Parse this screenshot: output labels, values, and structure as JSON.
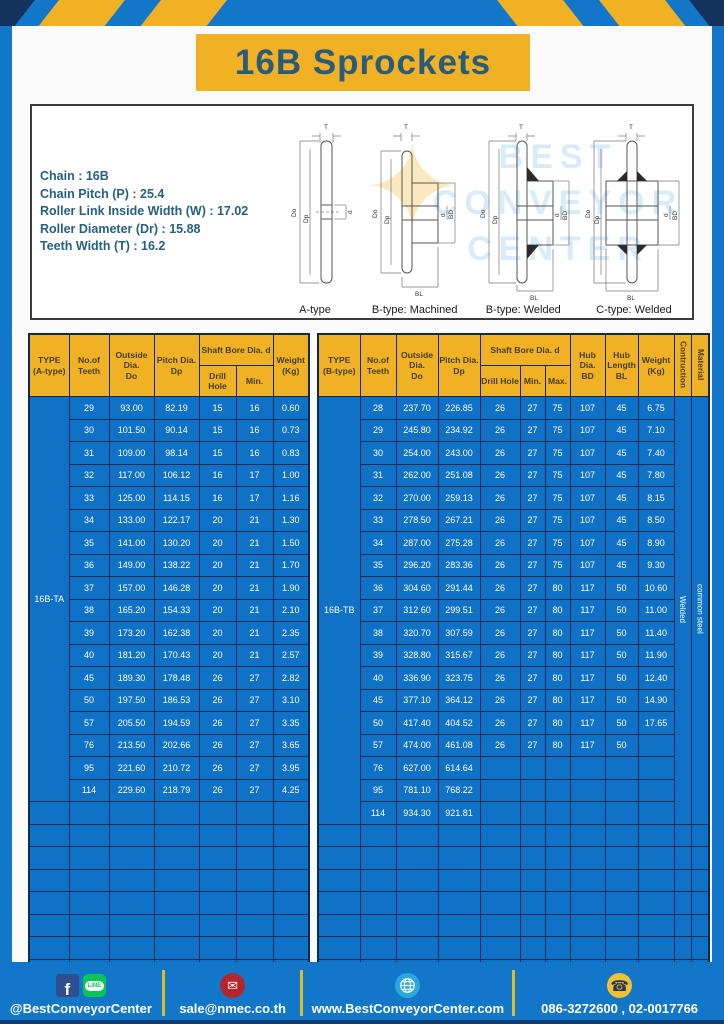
{
  "page_title": "16B Sprockets",
  "specs": {
    "lines": [
      "Chain : 16B",
      "Chain Pitch (P) : 25.4",
      "Roller Link Inside Width (W) : 17.02",
      "Roller Diameter (Dr) : 15.88",
      "Teeth Width (T) : 16.2"
    ]
  },
  "diagrams": {
    "labels": [
      "A-type",
      "B-type: Machined",
      "B-type: Welded",
      "C-type: Welded"
    ],
    "dims": {
      "T": "T",
      "Do": "Do",
      "Dp": "Dp",
      "d": "d",
      "BD": "BD",
      "BL": "BL"
    }
  },
  "watermark": {
    "star": "✦",
    "lines": "BEST\nCONVEYOR\nCENTER"
  },
  "table_a": {
    "header": {
      "type": "TYPE\n(A-type)",
      "teeth": "No.of\nTeeth",
      "outside": "Outside\nDia.\nDo",
      "pitch": "Pitch Dia.\nDp",
      "shaft_bore": "Shaft Bore Dia. d",
      "drill": "Drill Hole",
      "min": "Min.",
      "weight": "Weight\n(Kg)"
    },
    "type_label": "16B-TA",
    "rows": [
      [
        "29",
        "93.00",
        "82.19",
        "15",
        "16",
        "0.60"
      ],
      [
        "30",
        "101.50",
        "90.14",
        "15",
        "16",
        "0.73"
      ],
      [
        "31",
        "109.00",
        "98.14",
        "15",
        "16",
        "0.83"
      ],
      [
        "32",
        "117.00",
        "106.12",
        "16",
        "17",
        "1.00"
      ],
      [
        "33",
        "125.00",
        "114.15",
        "16",
        "17",
        "1.16"
      ],
      [
        "34",
        "133.00",
        "122.17",
        "20",
        "21",
        "1.30"
      ],
      [
        "35",
        "141.00",
        "130.20",
        "20",
        "21",
        "1.50"
      ],
      [
        "36",
        "149.00",
        "138.22",
        "20",
        "21",
        "1.70"
      ],
      [
        "37",
        "157.00",
        "146.28",
        "20",
        "21",
        "1.90"
      ],
      [
        "38",
        "165.20",
        "154.33",
        "20",
        "21",
        "2.10"
      ],
      [
        "39",
        "173.20",
        "162.38",
        "20",
        "21",
        "2.35"
      ],
      [
        "40",
        "181.20",
        "170.43",
        "20",
        "21",
        "2.57"
      ],
      [
        "45",
        "189.30",
        "178.48",
        "26",
        "27",
        "2.82"
      ],
      [
        "50",
        "197.50",
        "186.53",
        "26",
        "27",
        "3.10"
      ],
      [
        "57",
        "205.50",
        "194.59",
        "26",
        "27",
        "3.35"
      ],
      [
        "76",
        "213.50",
        "202.66",
        "26",
        "27",
        "3.65"
      ],
      [
        "95",
        "221.60",
        "210.72",
        "26",
        "27",
        "3.95"
      ],
      [
        "114",
        "229.60",
        "218.79",
        "26",
        "27",
        "4.25"
      ]
    ],
    "empty_rows": 8,
    "total_cols": 7
  },
  "table_b": {
    "header": {
      "type": "TYPE\n(B-type)",
      "teeth": "No.of\nTeeth",
      "outside": "Outside\nDia.\nDo",
      "pitch": "Pitch Dia.\nDp",
      "shaft_bore": "Shaft Bore Dia. d",
      "drill": "Drill Hole",
      "min": "Min.",
      "max": "Max.",
      "hub_dia": "Hub Dia.\nBD",
      "hub_len": "Hub\nLength\nBL",
      "weight": "Weight\n(Kg)",
      "construction": "Contruction",
      "material": "Material"
    },
    "type_label": "16B-TB",
    "construction_value": "Welded",
    "material_value": "common steel",
    "rows": [
      [
        "28",
        "237.70",
        "226.85",
        "26",
        "27",
        "75",
        "107",
        "45",
        "6.75"
      ],
      [
        "29",
        "245.80",
        "234.92",
        "26",
        "27",
        "75",
        "107",
        "45",
        "7.10"
      ],
      [
        "30",
        "254.00",
        "243.00",
        "26",
        "27",
        "75",
        "107",
        "45",
        "7.40"
      ],
      [
        "31",
        "262.00",
        "251.08",
        "26",
        "27",
        "75",
        "107",
        "45",
        "7.80"
      ],
      [
        "32",
        "270.00",
        "259.13",
        "26",
        "27",
        "75",
        "107",
        "45",
        "8.15"
      ],
      [
        "33",
        "278.50",
        "267.21",
        "26",
        "27",
        "75",
        "107",
        "45",
        "8.50"
      ],
      [
        "34",
        "287.00",
        "275.28",
        "26",
        "27",
        "75",
        "107",
        "45",
        "8.90"
      ],
      [
        "35",
        "296.20",
        "283.36",
        "26",
        "27",
        "75",
        "107",
        "45",
        "9.30"
      ],
      [
        "36",
        "304.60",
        "291.44",
        "26",
        "27",
        "80",
        "117",
        "50",
        "10.60"
      ],
      [
        "37",
        "312.60",
        "299.51",
        "26",
        "27",
        "80",
        "117",
        "50",
        "11.00"
      ],
      [
        "38",
        "320.70",
        "307.59",
        "26",
        "27",
        "80",
        "117",
        "50",
        "11.40"
      ],
      [
        "39",
        "328.80",
        "315.67",
        "26",
        "27",
        "80",
        "117",
        "50",
        "11.90"
      ],
      [
        "40",
        "336.90",
        "323.75",
        "26",
        "27",
        "80",
        "117",
        "50",
        "12.40"
      ],
      [
        "45",
        "377.10",
        "364.12",
        "26",
        "27",
        "80",
        "117",
        "50",
        "14.90"
      ],
      [
        "50",
        "417.40",
        "404.52",
        "26",
        "27",
        "80",
        "117",
        "50",
        "17.65"
      ],
      [
        "57",
        "474.00",
        "461.08",
        "26",
        "27",
        "80",
        "117",
        "50",
        ""
      ],
      [
        "76",
        "627.00",
        "614.64",
        "",
        "",
        "",
        "",
        "",
        ""
      ],
      [
        "95",
        "781.10",
        "768.22",
        "",
        "",
        "",
        "",
        "",
        ""
      ],
      [
        "114",
        "934.30",
        "921.81",
        "",
        "",
        "",
        "",
        "",
        ""
      ]
    ],
    "empty_rows": 7,
    "total_cols": 12
  },
  "footer": {
    "facebook_letter": "f",
    "line_label": "LINE",
    "mail_glyph": "✉",
    "phone_glyph": "☎",
    "items": [
      {
        "text": "@BestConveyorCenter"
      },
      {
        "text": "sale@nmec.co.th"
      },
      {
        "text": "www.BestConveyorCenter.com"
      },
      {
        "text": "086-3272600 , 02-0017766"
      }
    ]
  },
  "colors": {
    "frame_blue": "#1377C9",
    "cell_blue": "#0F72C6",
    "grid_navy": "#0D2B52",
    "accent_yellow": "#F0B125",
    "title_teal": "#2B5B7B"
  }
}
